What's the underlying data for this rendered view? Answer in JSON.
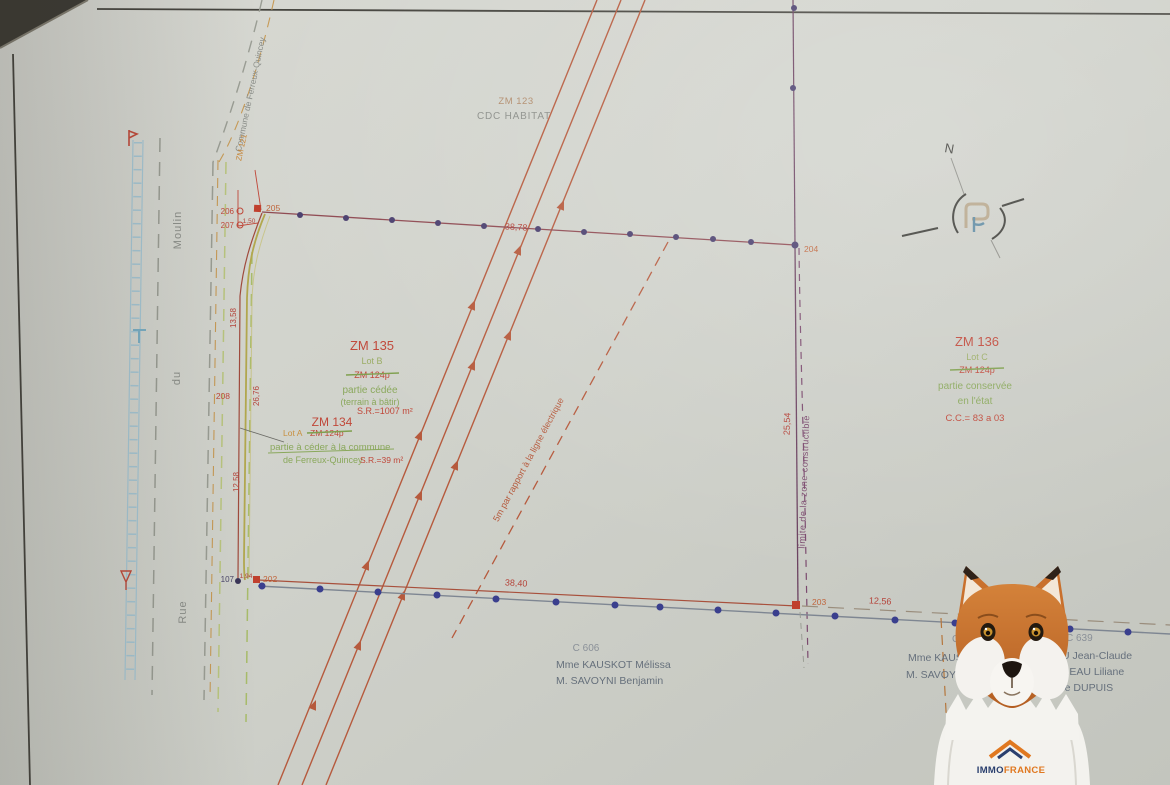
{
  "plan": {
    "north_label": "N",
    "parcel_zm123": {
      "id": "ZM 123",
      "owner": "CDC HABITAT"
    },
    "edge_zm121": {
      "id": "ZM 121",
      "commune": "Commune de Ferreux-Quincey"
    },
    "street": {
      "rue": "Rue",
      "du": "du",
      "moulin": "Moulin"
    },
    "lot_b": {
      "parcel": "ZM 135",
      "lot": "Lot B",
      "old": "ZM 124p",
      "line1": "partie cédée",
      "line2": "(terrain à bâtir)",
      "area": "S.R.=1007 m²"
    },
    "lot_a": {
      "parcel": "ZM 134",
      "lot": "Lot A",
      "old": "ZM 124p",
      "line1": "partie à céder à la commune",
      "line2": "de Ferreux-Quincey",
      "area": "S.R.=39 m²"
    },
    "lot_c": {
      "parcel": "ZM 136",
      "lot": "Lot C",
      "old": "ZM 124p",
      "line1": "partie conservée",
      "line2": "en l'état",
      "area": "C.C.= 83 a 03"
    },
    "notes": {
      "power": "5m par rapport à la ligne électrique",
      "limit": "limite de la zone constructible"
    },
    "points": {
      "p107": "107",
      "p202": "202",
      "p203": "203",
      "p204": "204",
      "p205": "205",
      "p206": "206",
      "p207": "207",
      "p208": "208"
    },
    "measures": {
      "m_top": "38,78",
      "m_bottom": "38,40",
      "m_right": "25,54",
      "m_far_right": "12,56",
      "m_150": "1,50",
      "m_194": "1,94",
      "m_1358": "13,58",
      "m_2676": "26,76",
      "m_1258": "12,58"
    },
    "owners": {
      "c606": {
        "ref": "C 606",
        "l1": "Mme KAUSKOT Mélissa",
        "l2": "M. SAVOYNI Benjamin"
      },
      "c640": {
        "ref": "C 64",
        "l1": "Mme KAUSKO",
        "l2": "M. SAVOYNI B"
      },
      "c639": {
        "ref": "C 639",
        "l1": "EAU Jean-Claude",
        "l2": "MEREAU Liliane",
        "l3": "née DUPUIS"
      }
    }
  },
  "mascot": {
    "brand_immo": "IMMO",
    "brand_france": "FRANCE"
  },
  "colors": {
    "red": "#c0483a",
    "green": "#8aa85c",
    "orange": "#c8883c",
    "purple": "#6b4a78",
    "grey": "#8a8d88",
    "names": "#66707c",
    "power": "#b65a3d",
    "paper": "#d2d3cc"
  }
}
